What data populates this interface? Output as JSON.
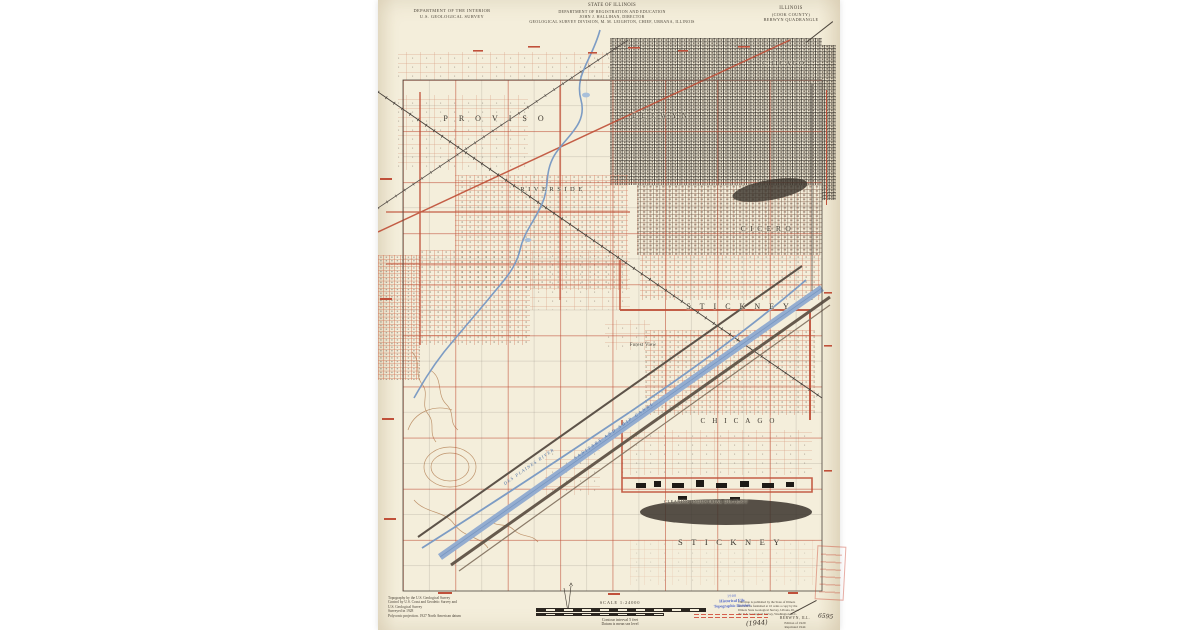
{
  "header": {
    "left": [
      "DEPARTMENT OF THE INTERIOR",
      "U.S. GEOLOGICAL SURVEY"
    ],
    "center": [
      "STATE OF ILLINOIS",
      "DEPARTMENT OF REGISTRATION AND EDUCATION",
      "JOHN J. HALLIHAN, DIRECTOR",
      "GEOLOGICAL SURVEY DIVISION, M. M. LEIGHTON, CHIEF, URBANA, ILLINOIS"
    ],
    "right": [
      "ILLINOIS",
      "(COOK COUNTY)",
      "BERWYN QUADRANGLE"
    ]
  },
  "map": {
    "place_labels": [
      {
        "text": "PROVISO"
      },
      {
        "text": "BERWYN"
      },
      {
        "text": "CHICAGO"
      },
      {
        "text": "RIVERSIDE"
      },
      {
        "text": "CICERO"
      },
      {
        "text": "STICKNEY"
      },
      {
        "text": "Forest View"
      },
      {
        "text": "CHICAGO"
      },
      {
        "text": "CLEARING INDUSTRIAL DISTRICT"
      },
      {
        "text": "STICKNEY"
      }
    ],
    "water_labels": [
      {
        "text": "DES PLAINES RIVER"
      },
      {
        "text": "SANITARY AND SHIP CANAL"
      }
    ]
  },
  "footer": {
    "credits": [
      "Topography by the U.S. Geological Survey",
      "Control by U.S. Coast and Geodetic Survey and",
      "U.S. Geological Survey",
      "Surveyed in 1928",
      "Polyconic projection. 1927 North American datum"
    ],
    "scale_label": "SCALE 1:24000",
    "contour_note": "Contour interval 5 feet",
    "datum_note": "Datum is mean sea level",
    "note_lines": [
      "This map is published by the State of Illinois",
      "and will be furnished at 10 cents a copy by the",
      "Illinois State Geological Survey, Urbana, Ill., or",
      "the U.S. Geological Survey, Washington, D.C."
    ],
    "edition": [
      "BERWYN, ILL.",
      "Edition of 1929",
      "Reprinted 1944"
    ],
    "handwriting_left": "(1944)",
    "handwriting_right": "6595"
  },
  "stamps": {
    "blue_lines": [
      "1908",
      "Historical File",
      "Topographic Division"
    ]
  },
  "colors": {
    "paper": "#f4eedb",
    "map_red": "#bf4f37",
    "water_blue": "#94add0",
    "stamp_blue": "#3a55c8",
    "stamp_red": "#cf3b2a"
  }
}
